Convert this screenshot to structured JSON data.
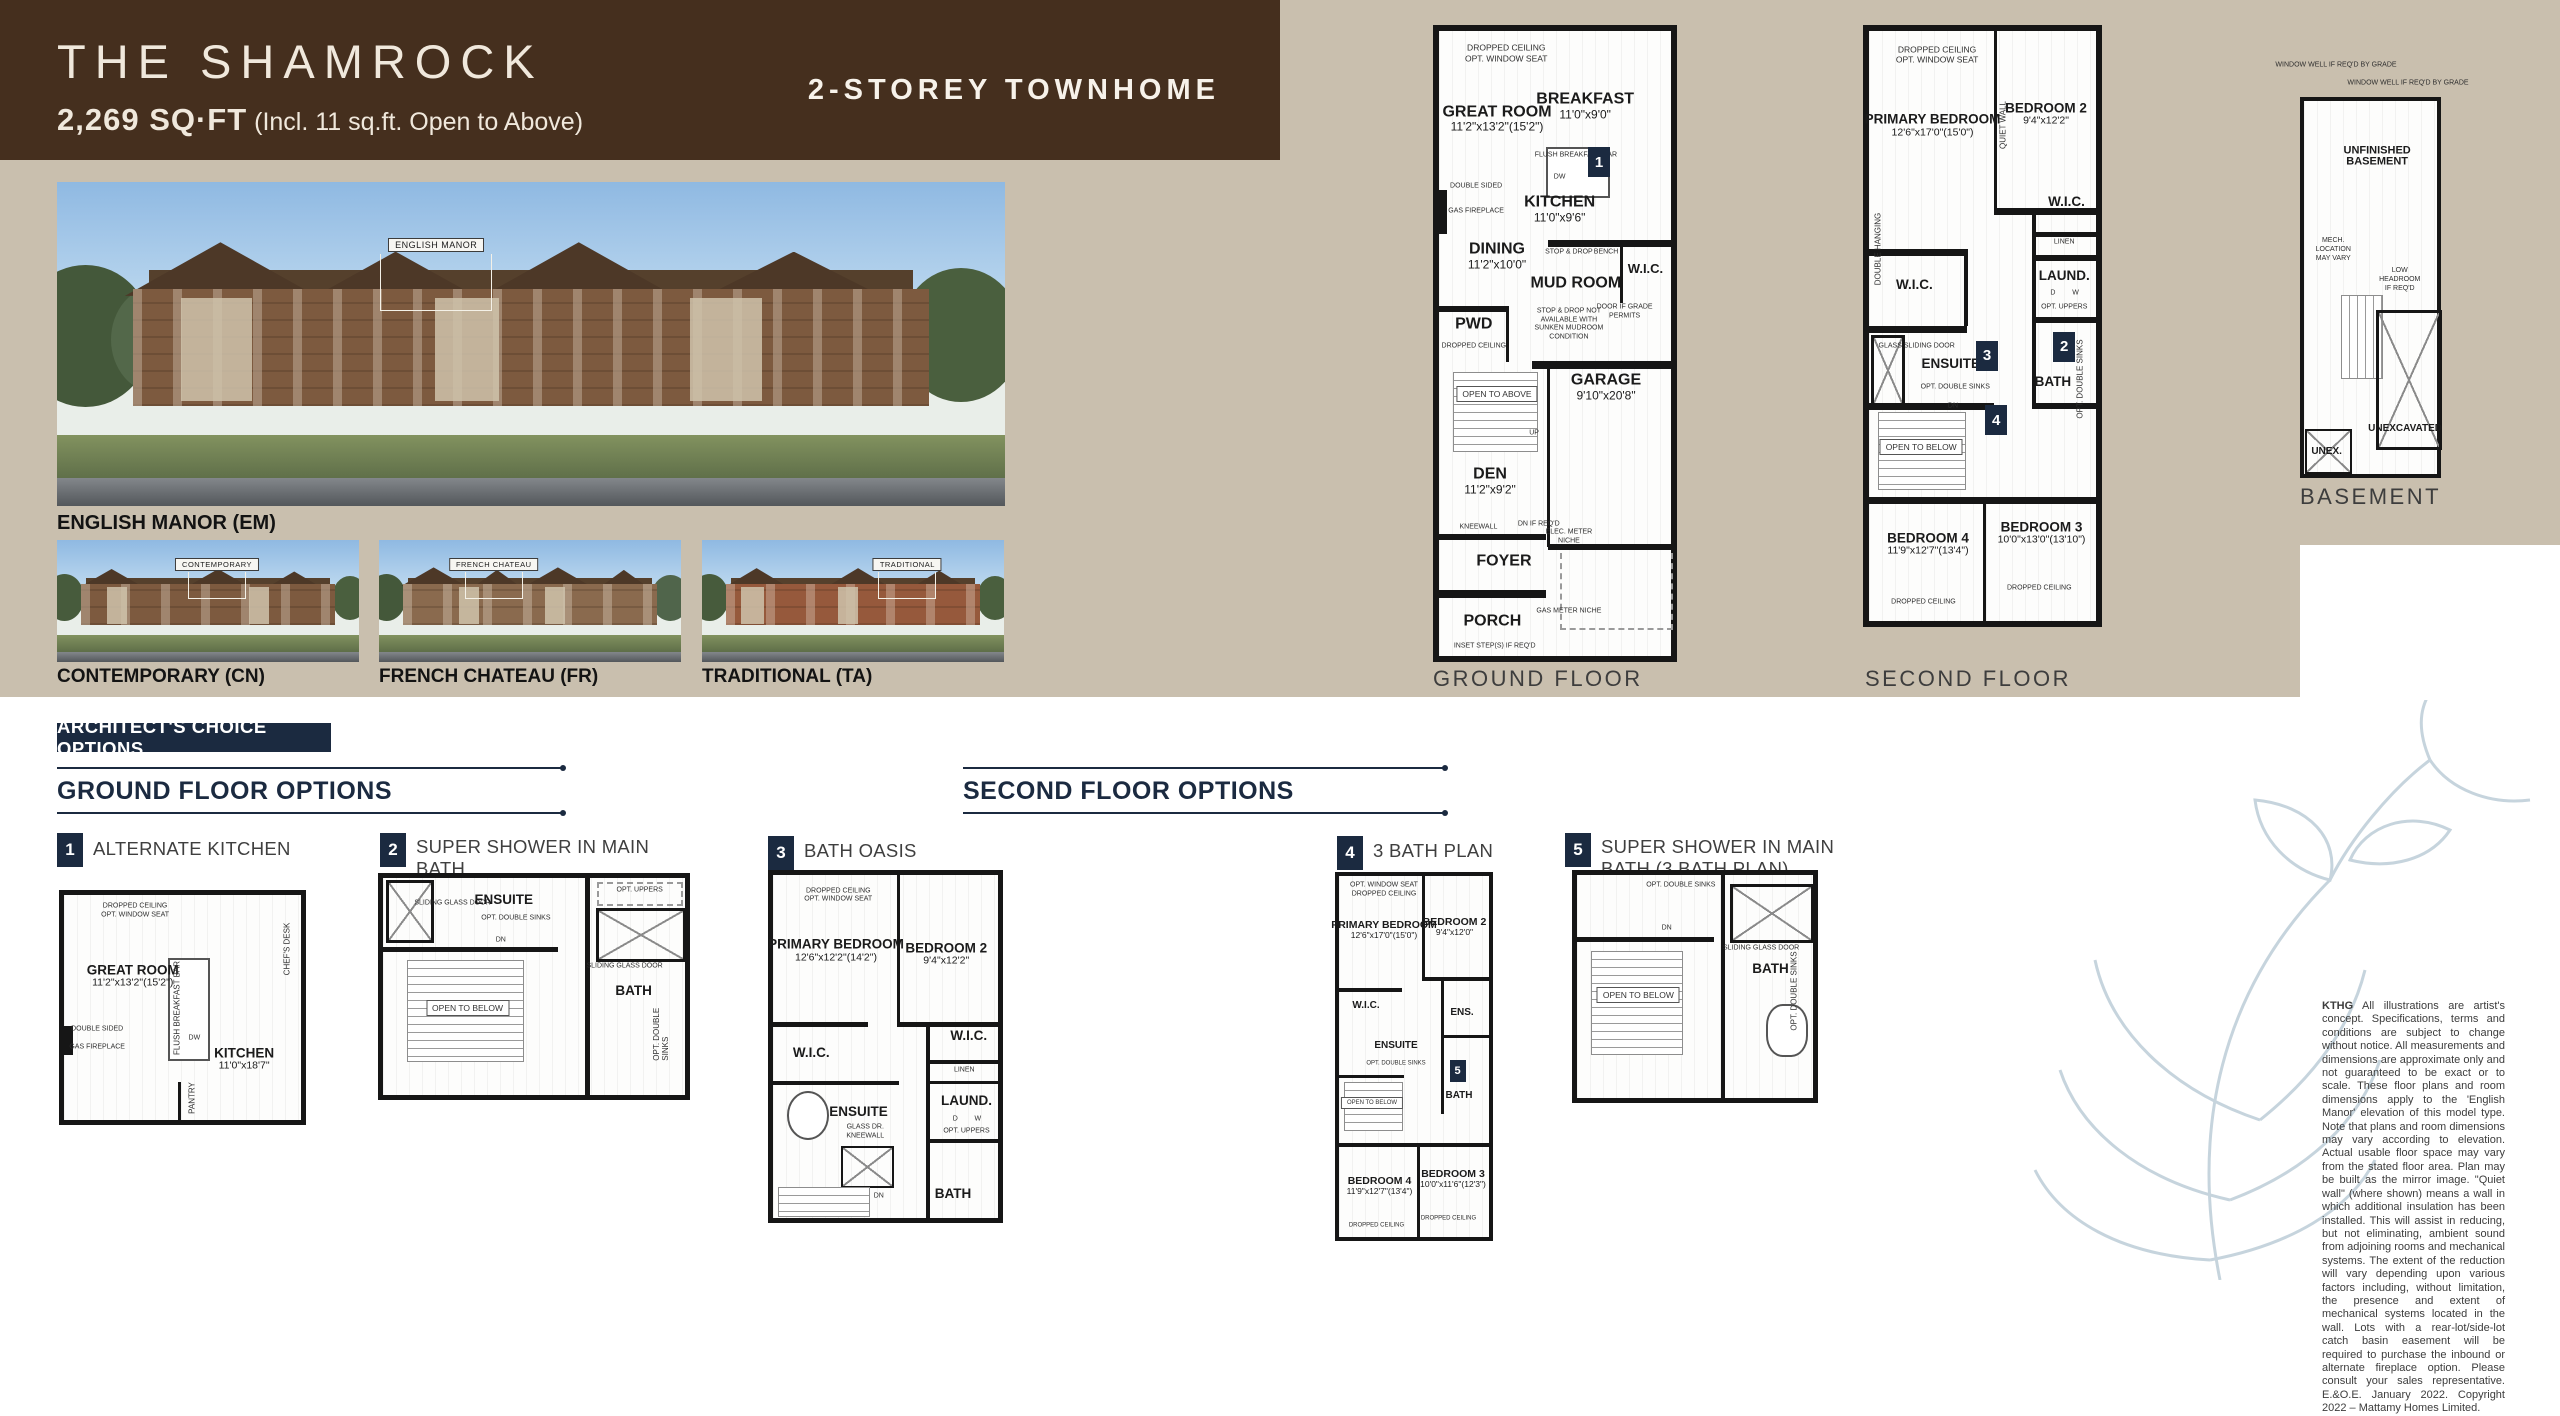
{
  "header": {
    "title": "THE SHAMROCK",
    "sqft": "2,269 SQ·FT",
    "sqft_note": " (Incl. 11 sq.ft. Open to Above)",
    "type_label": "2-STOREY TOWNHOME"
  },
  "elevations": {
    "main": {
      "callout": "ENGLISH MANOR",
      "label": "ENGLISH MANOR (EM)"
    },
    "thumbs": [
      {
        "callout": "CONTEMPORARY",
        "label": "CONTEMPORARY (CN)"
      },
      {
        "callout": "FRENCH CHATEAU",
        "label": "FRENCH CHATEAU (FR)"
      },
      {
        "callout": "TRADITIONAL",
        "label": "TRADITIONAL (TA)"
      }
    ]
  },
  "badges": {
    "b1": "1",
    "b2": "2",
    "b3": "3",
    "b4": "4",
    "b5": "5"
  },
  "ann": {
    "dropped_ceiling": "DROPPED CEILING",
    "opt_window_seat": "OPT. WINDOW SEAT",
    "flush_breakfast_bar": "FLUSH BREAKFAST BAR",
    "double_sided": "DOUBLE SIDED",
    "gas_fireplace": "GAS FIREPLACE",
    "stop_drop": "STOP & DROP",
    "bench": "BENCH",
    "stop_drop_note": "STOP & DROP NOT AVAILABLE WITH SUNKEN MUDROOM CONDITION",
    "door_grade": "DOOR IF GRADE PERMITS",
    "open_to_above": "OPEN TO ABOVE",
    "open_to_below": "OPEN TO BELOW",
    "up": "UP",
    "dn": "DN",
    "dn_if_reqd": "DN IF REQ'D",
    "kneewall": "KNEEWALL",
    "elec_meter": "ELEC. METER NICHE",
    "gas_meter": "GAS METER NICHE",
    "inset_steps": "INSET STEP(S) IF REQ'D",
    "quiet_wall": "QUIET WALL",
    "double_hanging": "DOUBLE HANGING",
    "linen": "LINEN",
    "laund_d": "D",
    "laund_w": "W",
    "opt_uppers": "OPT. UPPERS",
    "glass_sliding_door": "GLASS SLIDING DOOR",
    "sliding_glass_door": "SLIDING GLASS DOOR",
    "opt_double_sinks": "OPT. DOUBLE SINKS",
    "dw": "DW",
    "chefs_desk": "CHEF'S DESK",
    "pantry": "PANTRY",
    "window_well": "WINDOW WELL IF REQ'D BY GRADE",
    "low_headroom": "LOW HEADROOM IF REQ'D",
    "mech": "MECH. LOCATION MAY VARY",
    "glass_dr_kneewall": "GLASS DR. KNEEWALL"
  },
  "plans": {
    "ground": {
      "label": "GROUND FLOOR",
      "rooms": [
        {
          "name": "GREAT ROOM",
          "dims": "11'2\"x13'2\"(15'2\")"
        },
        {
          "name": "BREAKFAST",
          "dims": "11'0\"x9'0\""
        },
        {
          "name": "KITCHEN",
          "dims": "11'0\"x9'6\""
        },
        {
          "name": "DINING",
          "dims": "11'2\"x10'0\""
        },
        {
          "name": "MUD ROOM"
        },
        {
          "name": "W.I.C."
        },
        {
          "name": "PWD"
        },
        {
          "name": "GARAGE",
          "dims": "9'10\"x20'8\""
        },
        {
          "name": "DEN",
          "dims": "11'2\"x9'2\""
        },
        {
          "name": "FOYER"
        },
        {
          "name": "PORCH"
        }
      ]
    },
    "second": {
      "label": "SECOND FLOOR",
      "rooms": [
        {
          "name": "PRIMARY BEDROOM",
          "dims": "12'6\"x17'0\"(15'0\")"
        },
        {
          "name": "BEDROOM 2",
          "dims": "9'4\"x12'2\""
        },
        {
          "name": "W.I.C."
        },
        {
          "name": "W.I.C."
        },
        {
          "name": "LAUND."
        },
        {
          "name": "ENSUITE"
        },
        {
          "name": "BATH"
        },
        {
          "name": "BEDROOM 4",
          "dims": "11'9\"x12'7\"(13'4\")"
        },
        {
          "name": "BEDROOM 3",
          "dims": "10'0\"x13'0\"(13'10\")"
        }
      ]
    },
    "basement": {
      "label": "BASEMENT",
      "rooms": [
        {
          "name": "UNFINISHED BASEMENT"
        },
        {
          "name": "UNEXCAVATED"
        },
        {
          "name": "UNEX."
        }
      ]
    }
  },
  "options": {
    "banner": "ARCHITECT'S CHOICE OPTIONS",
    "ground_header": "GROUND FLOOR OPTIONS",
    "second_header": "SECOND FLOOR OPTIONS",
    "items": [
      {
        "num": "1",
        "label": "ALTERNATE KITCHEN",
        "rooms": [
          {
            "name": "GREAT ROOM",
            "dims": "11'2\"x13'2\"(15'2\")"
          },
          {
            "name": "KITCHEN",
            "dims": "11'0\"x18'7\""
          }
        ]
      },
      {
        "num": "2",
        "label": "SUPER SHOWER IN MAIN BATH",
        "rooms": [
          {
            "name": "ENSUITE"
          },
          {
            "name": "BATH"
          }
        ]
      },
      {
        "num": "3",
        "label": "BATH OASIS",
        "rooms": [
          {
            "name": "PRIMARY BEDROOM",
            "dims": "12'6\"x12'2\"(14'2\")"
          },
          {
            "name": "BEDROOM 2",
            "dims": "9'4\"x12'2\""
          },
          {
            "name": "W.I.C."
          },
          {
            "name": "W.I.C."
          },
          {
            "name": "ENSUITE"
          },
          {
            "name": "LAUND."
          },
          {
            "name": "BATH"
          }
        ]
      },
      {
        "num": "4",
        "label": "3 BATH PLAN",
        "rooms": [
          {
            "name": "PRIMARY BEDROOM",
            "dims": "12'6\"x17'0\"(15'0\")"
          },
          {
            "name": "BEDROOM 2",
            "dims": "9'4\"x12'0\""
          },
          {
            "name": "W.I.C."
          },
          {
            "name": "ENSUITE"
          },
          {
            "name": "ENS."
          },
          {
            "name": "BATH"
          },
          {
            "name": "BEDROOM 4",
            "dims": "11'9\"x12'7\"(13'4\")"
          },
          {
            "name": "BEDROOM 3",
            "dims": "10'0\"x11'6\"(12'3\")"
          }
        ]
      },
      {
        "num": "5",
        "label": "SUPER SHOWER IN MAIN BATH (3 BATH PLAN)",
        "rooms": [
          {
            "name": "BATH"
          }
        ]
      }
    ]
  },
  "disclaimer": {
    "lead": "KTHG",
    "body": " All illustrations are artist's concept. Specifications, terms and conditions are subject to change without notice. All measurements and dimensions are approximate only and not guaranteed to be exact or to scale. These floor plans and room dimensions apply to the 'English Manor' elevation of this model type. Note that plans and room dimensions may vary according to elevation. Actual usable floor space may vary from the stated floor area. Plan may be built as the mirror image. \"Quiet wall\" (where shown) means a wall in which additional insulation has been installed. This will assist in reducing, but not eliminating, ambient sound from adjoining rooms and mechanical systems. The extent of the reduction will vary depending upon various factors including, without limitation, the presence and extent of mechanical systems located in the wall. Lots with a rear-lot/side-lot catch basin easement will be required to purchase the inbound or alternate fireplace option. Please consult your sales representative. E.&O.E. January 2022. Copyright 2022 – Mattamy Homes Limited."
  },
  "colors": {
    "brown": "#452f1e",
    "tan": "#c9bfae",
    "navy": "#1b2a40",
    "fern": "#c6d4dd"
  }
}
